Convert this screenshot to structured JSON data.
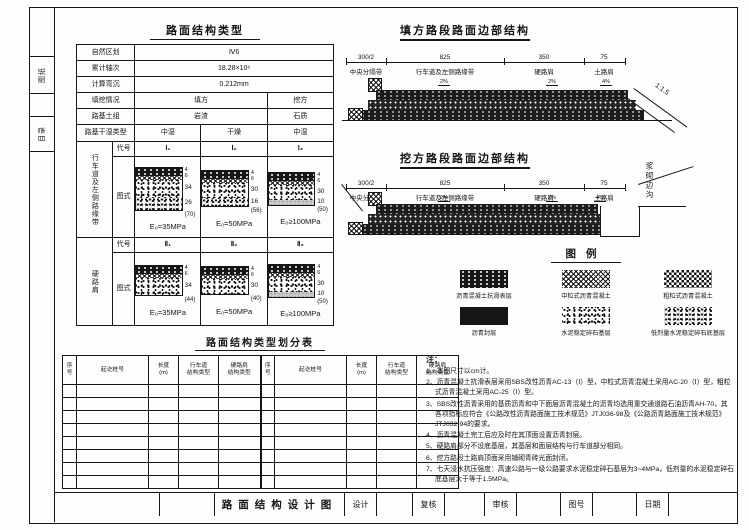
{
  "margin_tabs": [
    "图纸",
    "目录"
  ],
  "type_table": {
    "title": "路面结构类型",
    "info_rows": [
      {
        "label": "自然区划",
        "value": "Ⅳ6"
      },
      {
        "label": "累计轴次",
        "value": "18.28×10⁶"
      },
      {
        "label": "计算弯沉",
        "value": "0.212mm"
      }
    ],
    "fill_cut_rows": [
      {
        "label": "填挖情况",
        "fill": "填方",
        "cut": "挖方"
      },
      {
        "label": "路基土组",
        "fill": "岩渣",
        "cut": "石质"
      }
    ],
    "moisture_row": {
      "label": "路基干湿类型",
      "values": [
        "中湿",
        "干燥",
        "中湿"
      ]
    },
    "code_label": "代号",
    "diagram_label": "图式",
    "groups": [
      {
        "row_label": "行车道及左侧路缘带",
        "codes": [
          "Ⅰ₁",
          "Ⅰ₂",
          "Ⅰ₃"
        ],
        "diagrams": [
          {
            "surface_dims": [
              "4",
              "6"
            ],
            "layer_dims": [
              "34",
              "26"
            ],
            "total": "(70)",
            "modulus": "E₀=35MPa"
          },
          {
            "surface_dims": [
              "4",
              "6"
            ],
            "layer_dims": [
              "30",
              "16"
            ],
            "total": "(56)",
            "modulus": "E₀=50MPa"
          },
          {
            "surface_dims": [
              "4",
              "6"
            ],
            "layer_dims": [
              "30",
              "10"
            ],
            "total": "(50)",
            "modulus": "E₀≥100MPa"
          }
        ]
      },
      {
        "row_label": "硬路肩",
        "codes": [
          "Ⅱ₁",
          "Ⅱ₂",
          "Ⅱ₃"
        ],
        "diagrams": [
          {
            "surface_dims": [
              "4",
              "6"
            ],
            "layer_dims": [
              "34"
            ],
            "total": "(44)",
            "modulus": "E₀=35MPa"
          },
          {
            "surface_dims": [
              "4",
              "6"
            ],
            "layer_dims": [
              "30"
            ],
            "total": "(40)",
            "modulus": "E₀=50MPa"
          },
          {
            "surface_dims": [
              "4",
              "6"
            ],
            "layer_dims": [
              "30",
              "10"
            ],
            "total": "(50)",
            "modulus": "E₀≥100MPa"
          }
        ]
      }
    ]
  },
  "sections": [
    {
      "title": "填方路段路面边部结构",
      "dims": [
        "300/2",
        "825",
        "350",
        "75"
      ],
      "zone_labels": [
        "中央分隔带",
        "行车道及左侧路缘带",
        "硬路肩",
        "土路肩"
      ],
      "slope_labels": [
        "2%",
        "2%",
        "4%"
      ],
      "side_slope": "1:1.5"
    },
    {
      "title": "挖方路段路面边部结构",
      "dims": [
        "300/2",
        "825",
        "350",
        "75"
      ],
      "zone_labels": [
        "中央分隔带",
        "行车道及左侧路缘带",
        "硬路肩",
        "土路肩"
      ],
      "slope_labels": [
        "2%",
        "2%",
        "4%"
      ],
      "ditch_label": "浆砌边沟"
    }
  ],
  "legend": {
    "title": "图例",
    "items": [
      {
        "label": "沥青混凝土抗滑表层"
      },
      {
        "label": "中粒式沥青混凝土"
      },
      {
        "label": "粗粒式沥青混凝土"
      },
      {
        "label": "沥青封层"
      },
      {
        "label": "水泥稳定碎石基层"
      },
      {
        "label": "低剂量水泥稳定碎石底基层"
      }
    ]
  },
  "division_table": {
    "title": "路面结构类型划分表",
    "columns": [
      "序\n号",
      "起讫桩号",
      "长度\n(m)",
      "行车道\n结构类型",
      "硬路肩\n结构类型"
    ]
  },
  "notes": {
    "title": "注：",
    "items": [
      "1、本图尺寸以cm计。",
      "2、沥青混凝土抗滑表层采用SBS改性沥青AC-13（Ⅰ）型，中粒式沥青混凝土采用AC-20（Ⅰ）型，粗粒式沥青混凝土采用AC-25（Ⅰ）型。",
      "3、SBS改性沥青采用的基质沥青和中下面层沥青混凝土的沥青均选用重交通道路石油沥青AH-70，其各项指标应符合《公路改性沥青路面施工技术规范》JTJ036-98及《公路沥青路面施工技术规范》JTJ032-94的要求。",
      "4、沥青混凝土完工后应及时在其顶面设置沥青封层。",
      "5、硬路肩部分不设底基层，其基层和面层结构与行车道部分相同。",
      "6、挖方路段土路肩顶面采用铺砌青砖光面封闭。",
      "7、七天浸水抗压强度：高速公路与一级公路要求水泥稳定碎石基层为3~4MPa，低剂量的水泥稳定碎石底基层大于等于1.5MPa。"
    ]
  },
  "title_block": {
    "drawing_title": "路面结构设计图",
    "fields": [
      "设计",
      "复核",
      "审核",
      "图号",
      "日期"
    ]
  }
}
